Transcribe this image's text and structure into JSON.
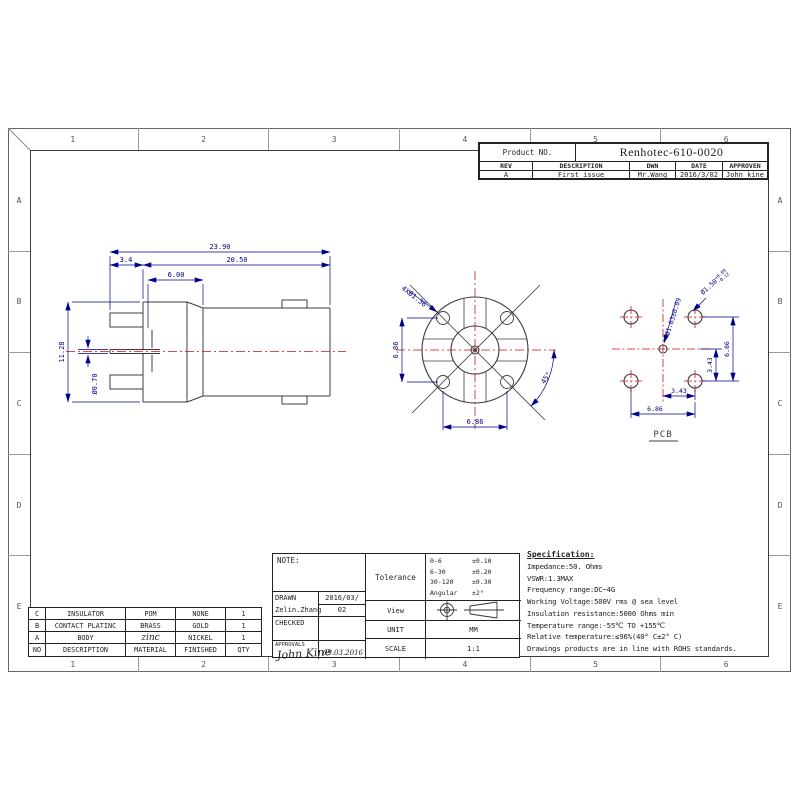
{
  "sheet": {
    "zone_cols": [
      "1",
      "2",
      "3",
      "4",
      "5",
      "6"
    ],
    "zone_rows": [
      "A",
      "B",
      "C",
      "D",
      "E"
    ]
  },
  "title_block": {
    "product_no_label": "Product NO.",
    "product_no": "Renhotec-610-0020",
    "col_rev": "REV",
    "col_description": "DESCRIPTION",
    "col_dwn": "DWN",
    "col_date": "DATE",
    "col_approven": "APPROVEN",
    "rev": "A",
    "description": "First issue",
    "dwn": "Mr.Wang",
    "date": "2016/3/02",
    "approven": "John kine"
  },
  "side_view": {
    "dim_overall": "23.90",
    "dim_front": "3.4",
    "dim_body": "20.50",
    "dim_mid": "6.00",
    "dim_height": "11.28",
    "dim_pin": "Ø0.70"
  },
  "front_view": {
    "holes_label": "4XØ1.36",
    "dim_vertical": "6.86",
    "dim_horizontal": "6.86",
    "angle_label": "45°"
  },
  "pcb_view": {
    "title": "PCB",
    "center_hole_label": "Ø1.03±0.09",
    "corner_hole_base": "Ø1.50",
    "corner_hole_tol_upper": "+0.09",
    "corner_hole_tol_lower": "-0.12",
    "dim_pitch_half_v": "3.43",
    "dim_pitch_v": "6.86",
    "dim_pitch_half_h": "3.43",
    "dim_pitch_h": "6.86"
  },
  "note_block": {
    "note_label": "NOTE:",
    "drawn_label": "DRAWN",
    "drawn_name": "Zelin.Zhang",
    "drawn_date_line1": "2016/03/",
    "drawn_date_line2": "02",
    "checked_label": "CHECKED",
    "approvals_label": "APPROVALS",
    "approvals_signature": "John Kine",
    "approvals_date": "09.03.2016"
  },
  "info_block": {
    "tolerance_label": "Tolerance",
    "tolerance_rows": [
      {
        "range": "0-6",
        "value": "±0.10"
      },
      {
        "range": "6-30",
        "value": "±0.20"
      },
      {
        "range": "30-120",
        "value": "±0.30"
      },
      {
        "range": "Angular",
        "value": "±2°"
      }
    ],
    "view_label": "View",
    "unit_label": "UNIT",
    "unit_value": "MM",
    "scale_label": "SCALE",
    "scale_value": "1:1"
  },
  "materials": {
    "rows": [
      [
        "C",
        "INSULATOR",
        "POM",
        "NONE",
        "1"
      ],
      [
        "B",
        "CONTACT PLATINC",
        "BRASS",
        "GOLD",
        "1"
      ],
      [
        "A",
        "BODY",
        "zinc",
        "NICKEL",
        "1"
      ],
      [
        "NO",
        "DESCRIPTION",
        "MATERIAL",
        "FINISHED",
        "QTY"
      ]
    ]
  },
  "specification": {
    "title": "Specification:",
    "lines": [
      "Impedance:50. Ohms",
      "VSWR:1.3MAX",
      "Frequency range:DC~4G",
      "Working Voltage:500V rms @ sea level",
      "Insulation resistance:5000 Ohms min",
      "Temperature range:-55℃ TO +155℃",
      "Relative temperature:≤96%(40° C±2° C)",
      "Drawings products are in line with ROHS standards."
    ]
  },
  "colors": {
    "dimension": "#00008b",
    "centerline": "#c81414",
    "outline": "#3c3c3c"
  }
}
